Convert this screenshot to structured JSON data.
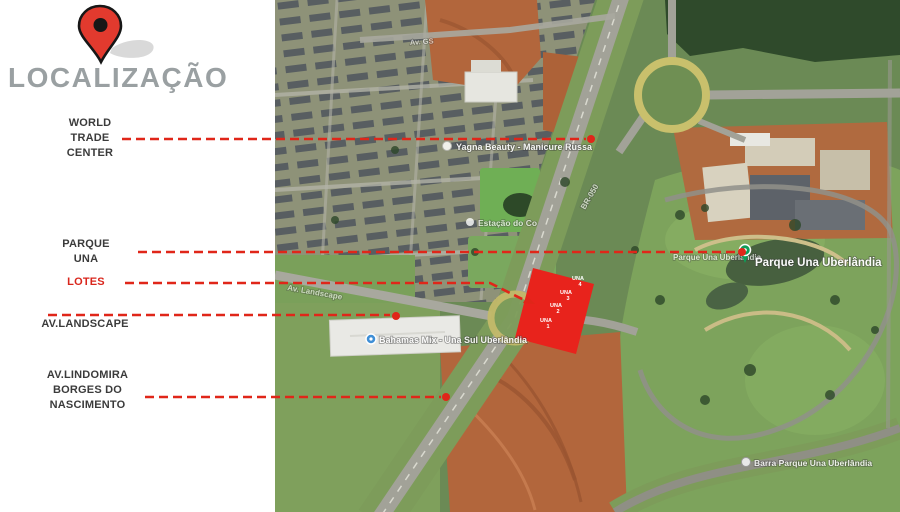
{
  "title": "LOCALIZAÇÃO",
  "left_labels": {
    "world_trade_center": [
      "WORLD",
      "TRADE",
      "CENTER"
    ],
    "parque_una": [
      "PARQUE",
      "UNA"
    ],
    "lotes": "LOTES",
    "av_landscape": "AV.LANDSCAPE",
    "av_lindomira": [
      "AV.LINDOMIRA",
      "BORGES DO",
      "NASCIMENTO"
    ]
  },
  "map": {
    "place_labels": {
      "beauty_salon": "Yagna Beauty - Manicure Russa",
      "station": "Estação do Co",
      "parque_una_small": "Parque Una Uberlândia",
      "parque_una_main": "Parque Una Uberlândia",
      "supermarket": "Bahamas Mix - Una Sul Uberlândia",
      "bar_parque": "Barra Parque Una Uberlândia",
      "road_av_landscape": "Av. Landscape",
      "road_br050": "BR-050",
      "road_av_top": "Av. GS"
    },
    "lots": [
      {
        "name": "UNA",
        "num": "4"
      },
      {
        "name": "UNA",
        "num": "3"
      },
      {
        "name": "UNA",
        "num": "2"
      },
      {
        "name": "UNA",
        "num": "1"
      }
    ]
  },
  "colors": {
    "leader_red": "#e02619",
    "lotes_red": "#d9261c",
    "title_gray": "#9aa0a2",
    "label_dark": "#3b3b3b",
    "lot_fill": "#e8231c",
    "pin_red": "#e23a2e",
    "park_pin_green": "#0e9e58",
    "market_pin_blue": "#3f8fd6"
  }
}
